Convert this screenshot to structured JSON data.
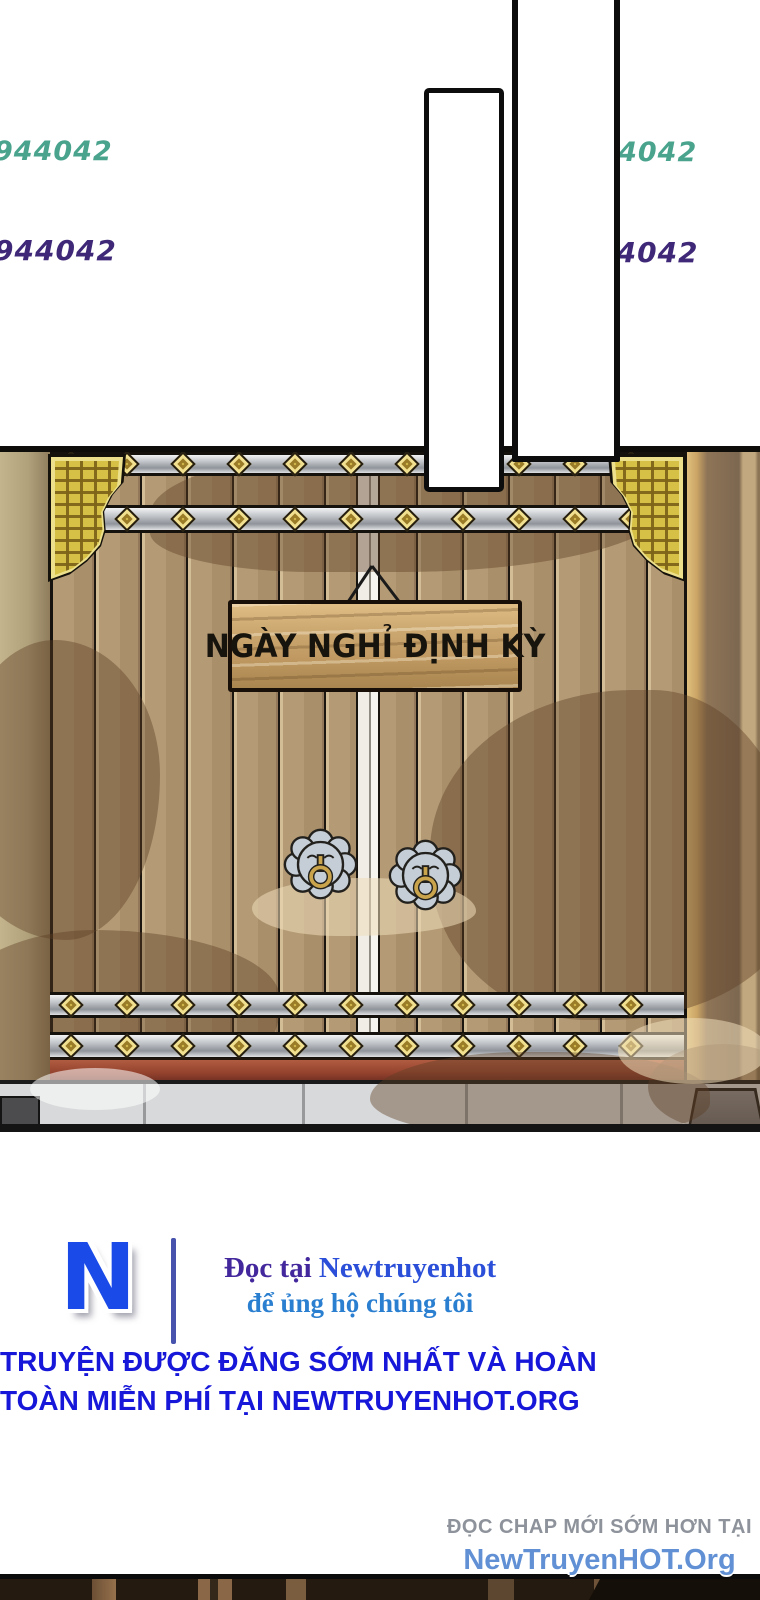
{
  "watermarks": {
    "left_top": "944042",
    "left_bottom": "944042",
    "right_top": "vt944042",
    "right_bottom": "vt944042"
  },
  "gate": {
    "sign_text": "NGÀY NGHỈ ĐỊNH KỲ"
  },
  "footer": {
    "logo_letter": "N",
    "support_prefix": "Đọc tại ",
    "support_site": "Newtruyenhot",
    "support_line2": "để ủng hộ chúng tôi",
    "promo_line1": "TRUYỆN ĐƯỢC ĐĂNG SỚM NHẤT VÀ HOÀN",
    "promo_line2": "TOÀN MIỄN PHÍ TẠI NEWTRUYENHOT.ORG",
    "read_early_label": "ĐỌC CHAP MỚI SỚM HƠN TẠI",
    "site_name": "NewTruyenHOT.Org"
  },
  "icons": {
    "diamond_stud": "diamond-stud-icon",
    "door_knocker": "door-knocker-icon",
    "corner_bracket": "corner-bracket-icon",
    "sign_string": "sign-string-icon",
    "logo_n": "newtruyenhot-logo"
  },
  "colors": {
    "watermark_teal": "#4aa38d",
    "watermark_purple": "#3e2877",
    "promo_blue": "#1717d9",
    "read_early_grey": "#8e939b",
    "site_blue": "#6190d5",
    "logo_blue": "#1a4ae8",
    "divider_indigo": "#4753ad",
    "support_indigo": "#43279c",
    "support_blue": "#2b4fd8",
    "support_cyan": "#2a7fd0",
    "plank_brown": "#b49b76",
    "band_silver": "#c3c6ca",
    "stud_gold": "#d9c050",
    "bracket_gold": "#d6c146",
    "sign_wood": "#c09a62",
    "sill_red": "#97442f",
    "stone_grey": "#d8d9da"
  }
}
